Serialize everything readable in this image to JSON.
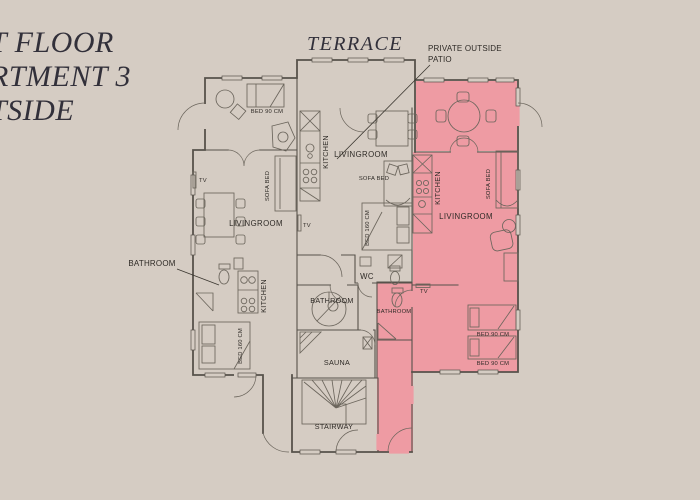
{
  "colors": {
    "background": "#d5ccc3",
    "highlight": "#ee9ba3",
    "wall": "#57524b",
    "text": "#2e2a26",
    "title_text": "#32303a"
  },
  "title": {
    "line1": "T FLOOR",
    "line2": "RTMENT 3",
    "line3": "TSIDE"
  },
  "annotations": {
    "terrace": "TERRACE",
    "patio_note_line1": "PRIVATE OUTSIDE",
    "patio_note_line2": "PATIO",
    "bathroom_callout": "BATHROOM"
  },
  "common": {
    "stairway": "STAIRWAY",
    "sauna": "SAUNA",
    "wc": "WC",
    "bathroom": "BATHROOM"
  },
  "apartment_left": {
    "bed90": "BED 90 CM",
    "tv": "TV",
    "livingroom": "LIVINGROOM",
    "sofa_bed": "SOFA BED",
    "kitchen": "KITCHEN",
    "bed160": "BED 160 CM"
  },
  "apartment_middle": {
    "kitchen": "KITCHEN",
    "livingroom": "LIVINGROOM",
    "sofa_bed": "SOFA BED",
    "bed160": "BED 160 CM",
    "tv": "TV"
  },
  "apartment_highlighted": {
    "kitchen": "KITCHEN",
    "livingroom": "LIVINGROOM",
    "sofa_bed": "SOFA BED",
    "tv": "TV",
    "bathroom": "BATHROOM",
    "bed90_first": "BED 90 CM",
    "bed90_second": "BED 90 CM"
  }
}
